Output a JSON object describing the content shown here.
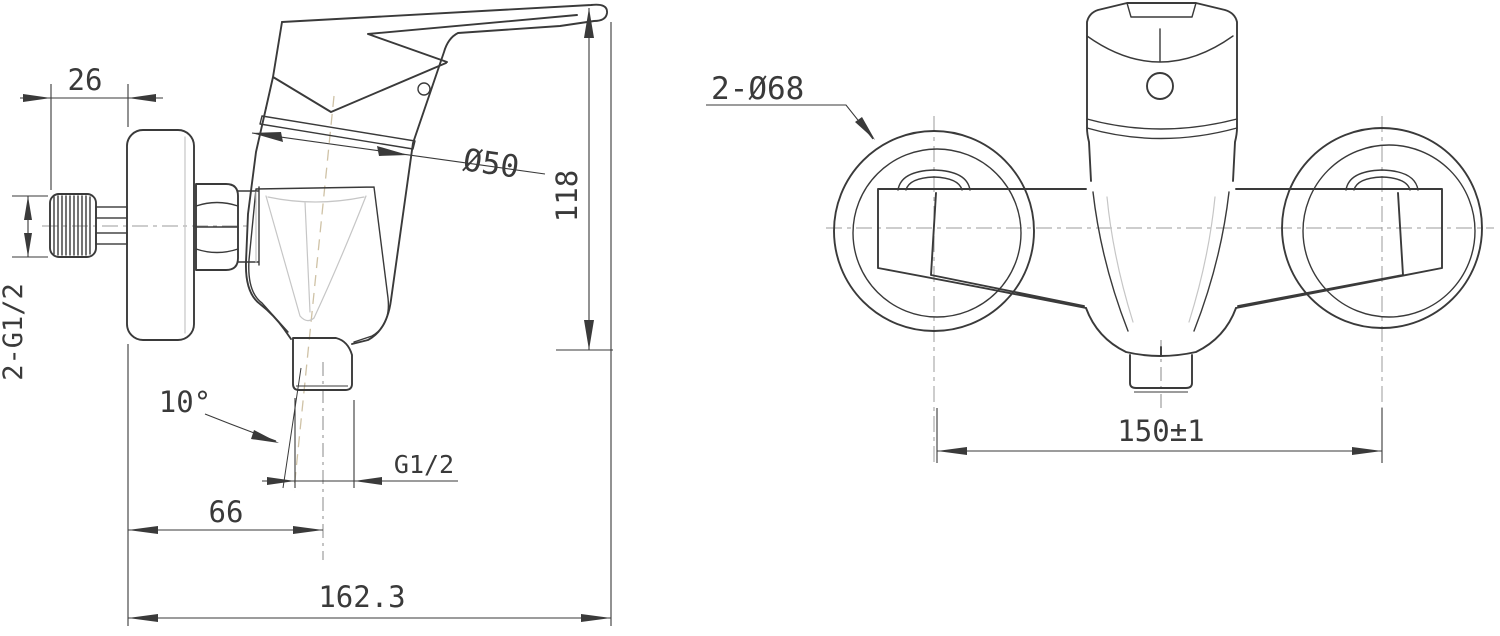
{
  "page": {
    "background": "#ffffff",
    "description": "Technical dimension drawing of a wall-mounted single-lever shower mixer: side view (left) and front view (right)"
  },
  "style": {
    "line_color": "#3a3a3a",
    "construction_line_color": "#c6c6c6",
    "axis_line_color": "#cfc2a6"
  },
  "side_view": {
    "name": "Side view",
    "dimensions": {
      "knob_to_wall": "26",
      "inlet_thread": "2-G1/2",
      "cartridge_diameter": "Ø50",
      "height_to_handle_tip": "118",
      "outlet_tilt_angle": "10°",
      "outlet_thread": "G1/2",
      "wall_to_outlet_axis": "66",
      "overall_depth": "162.3"
    }
  },
  "front_view": {
    "name": "Front view",
    "dimensions": {
      "escutcheon_diameter": "2-Ø68",
      "inlet_centre_distance": "150±1"
    }
  }
}
